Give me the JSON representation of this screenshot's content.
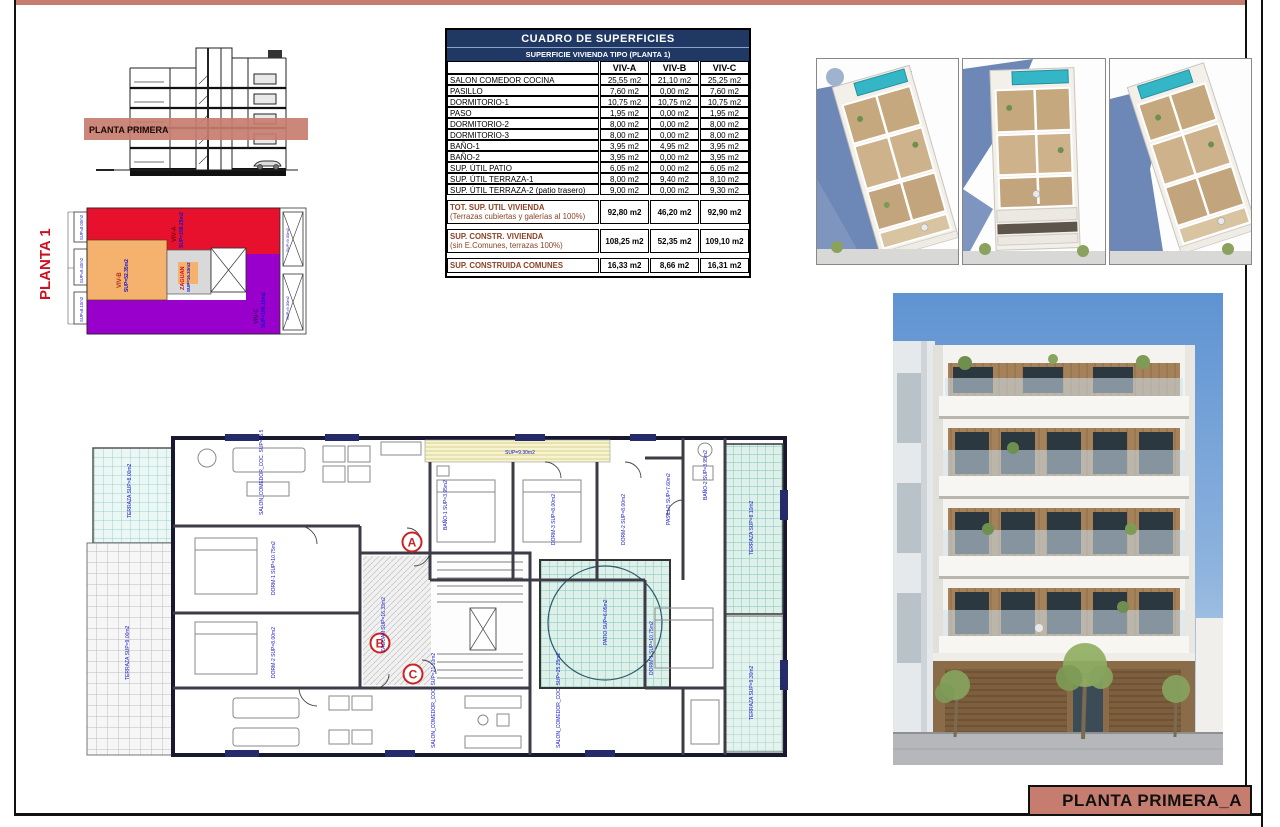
{
  "sheet": {
    "title_box_label": "PLANTA PRIMERA_A",
    "accent_color": "#c67d6f",
    "table_header_color": "#1f3864"
  },
  "section": {
    "band_label": "PLANTA PRIMERA"
  },
  "keyplan": {
    "title": "PLANTA 1",
    "zones": [
      {
        "name": "VIV-A",
        "sup": "SUP=108.25m2",
        "color": "#e8112d"
      },
      {
        "name": "VIV-B",
        "sup": "SUP=52.35m2",
        "color": "#f4b26e"
      },
      {
        "name": "ZAGUAN",
        "sup": "SUP=16.33m2",
        "color": "#d9d9d9"
      },
      {
        "name": "VIV-C",
        "sup": "SUP=109.10m2",
        "color": "#9900cc"
      }
    ],
    "side_labels": [
      "SUP=8.00m2",
      "SUP=9.40m2",
      "SUP=8.10m2"
    ],
    "right_labels": [
      "SUP=9.00m2",
      "SUP=9.30m2"
    ]
  },
  "surfaces_table": {
    "title": "CUADRO DE SUPERFICIES",
    "subtitle": "SUPERFICIE VIVIENDA TIPO  (PLANTA 1)",
    "columns": [
      "VIV-A",
      "VIV-B",
      "VIV-C"
    ],
    "rows": [
      {
        "label": "SALON COMEDOR COCINA",
        "a": "25,55 m2",
        "b": "21,10 m2",
        "c": "25,25 m2"
      },
      {
        "label": "PASILLO",
        "a": "7,60 m2",
        "b": "0,00 m2",
        "c": "7,60 m2"
      },
      {
        "label": "DORMITORIO-1",
        "a": "10,75 m2",
        "b": "10,75 m2",
        "c": "10,75 m2"
      },
      {
        "label": "PASO",
        "a": "1,95 m2",
        "b": "0,00 m2",
        "c": "1,95 m2"
      },
      {
        "label": "DORMITORIO-2",
        "a": "8,00 m2",
        "b": "0,00 m2",
        "c": "8,00 m2"
      },
      {
        "label": "DORMITORIO-3",
        "a": "8,00 m2",
        "b": "0,00 m2",
        "c": "8,00 m2"
      },
      {
        "label": "BAÑO-1",
        "a": "3,95 m2",
        "b": "4,95 m2",
        "c": "3,95 m2"
      },
      {
        "label": "BAÑO-2",
        "a": "3,95 m2",
        "b": "0,00 m2",
        "c": "3,95 m2"
      },
      {
        "label": "SUP. ÚTIL PATIO",
        "a": "6,05 m2",
        "b": "0,00 m2",
        "c": "6,05 m2"
      },
      {
        "label": "SUP. ÚTIL TERRAZA-1",
        "a": "8,00 m2",
        "b": "9,40 m2",
        "c": "8,10 m2"
      },
      {
        "label": "SUP. ÚTIL TERRAZA-2 (patio trasero)",
        "a": "9,00 m2",
        "b": "0,00 m2",
        "c": "9,30 m2"
      }
    ],
    "summary": [
      {
        "label": "TOT. SUP. UTIL VIVIENDA",
        "sublabel": "(Terrazas cubiertas y galerías al 100%)",
        "a": "92,80 m2",
        "b": "46,20 m2",
        "c": "92,90 m2"
      },
      {
        "label": "SUP. CONSTR. VIVIENDA",
        "sublabel": "(sin E.Comunes, terrazas 100%)",
        "a": "108,25 m2",
        "b": "52,35 m2",
        "c": "109,10 m2"
      },
      {
        "label": "SUP. CONSTRUIDA COMUNES",
        "sublabel": "",
        "a": "16,33 m2",
        "b": "8,66 m2",
        "c": "16,31 m2"
      }
    ]
  },
  "floorplan": {
    "markers": [
      {
        "letter": "A"
      },
      {
        "letter": "B"
      },
      {
        "letter": "C"
      }
    ],
    "labels": [
      {
        "text": "TERRAZA SUP=8.00m2"
      },
      {
        "text": "TERRAZA SUP=9.00m2"
      },
      {
        "text": "SALON_COMEDOR_COC. SUP=25.55m2"
      },
      {
        "text": "DORM-1 SUP=10.75m2"
      },
      {
        "text": "DORM-2 SUP=8.00m2"
      },
      {
        "text": "BAÑO-1 SUP=3.95m2"
      },
      {
        "text": "DORM-3 SUP=8.00m2"
      },
      {
        "text": "DORM-2 SUP=8.00m2"
      },
      {
        "text": "SUP=9.30m2"
      },
      {
        "text": "PASILLO SUP=7.60m2"
      },
      {
        "text": "BAÑO-2 SUP=3.95m2"
      },
      {
        "text": "DORM-1 SUP=10.75m2"
      },
      {
        "text": "TERRAZA SUP=8.10m2"
      },
      {
        "text": "TERRAZA SUP=9.30m2"
      },
      {
        "text": "PATIO SUP=6.05m2"
      },
      {
        "text": "ZAGUAN SUP=16.33m2"
      },
      {
        "text": "SALON_COMEDOR_COC. SUP=21.10m2"
      },
      {
        "text": "SALON_COMEDOR_COC. SUP=25.25m2"
      }
    ]
  }
}
